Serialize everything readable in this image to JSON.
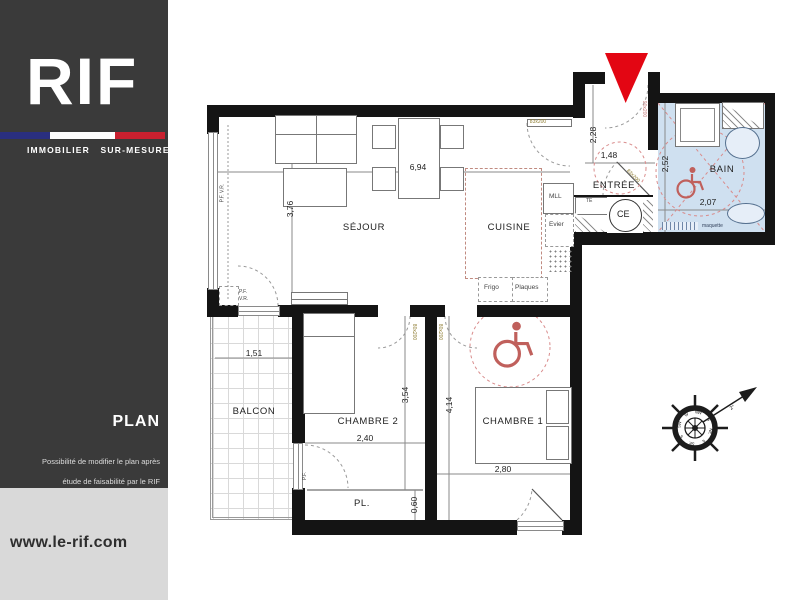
{
  "sidebar": {
    "logo_text": "RIF",
    "tagline": "IMMOBILIER SUR-MESURE",
    "section_label": "PLAN",
    "note_line1": "Possibilité de modifier le plan après",
    "note_line2": "étude de faisabilité par le RIF",
    "website": "www.le-rif.com",
    "colors": {
      "background": "#3a3a3a",
      "footer_background": "#d9d9d9",
      "flag_blue": "#2a2f7f",
      "flag_red": "#c8202f"
    }
  },
  "plan": {
    "rooms": {
      "sejour": "SÉJOUR",
      "cuisine": "CUISINE",
      "entree": "ENTRÉE",
      "bain": "BAIN",
      "balcon": "BALCON",
      "chambre2": "CHAMBRE 2",
      "chambre1": "CHAMBRE 1",
      "placard": "PL."
    },
    "dimensions": {
      "sejour_width": "6,94",
      "sejour_height": "3,76",
      "entree_height": "2,28",
      "entree_width": "1,48",
      "bain_height": "2,52",
      "bain_width": "2,07",
      "balcon_width": "1,51",
      "chambre2_width": "2,40",
      "chambre2_height": "3,54",
      "chambre1_height": "4,14",
      "chambre1_width": "2,80",
      "placard_depth": "0,60"
    },
    "fixtures": {
      "washing_machine": "MLL",
      "kitchen_sink": "Evier",
      "fridge": "Frigo",
      "hob": "Plaques",
      "water_heater": "CE",
      "electrical_board": "TE",
      "flooring_note": "maquette"
    },
    "door_labels": {
      "sejour_door": "83x200",
      "bain_door": "83x200",
      "entrance_door": "90x200",
      "chambre2_door": "80x200",
      "chambre1_door": "80x200"
    },
    "window_labels": {
      "sejour_window_side": "P.F. V.R.",
      "sejour_window_bottom": "P.F.\nV.R.",
      "chambre2_window": "P.F."
    },
    "compass": {
      "points": [
        "N",
        "NE",
        "E",
        "SE",
        "S",
        "SW",
        "W",
        "NW"
      ],
      "arrow_label": "2°"
    },
    "colors": {
      "accent_red": "#e30613",
      "bain_fill": "#cfe0f0",
      "dashed_pink": "#d98c8c",
      "door_label_olive": "#8f7d33"
    }
  }
}
